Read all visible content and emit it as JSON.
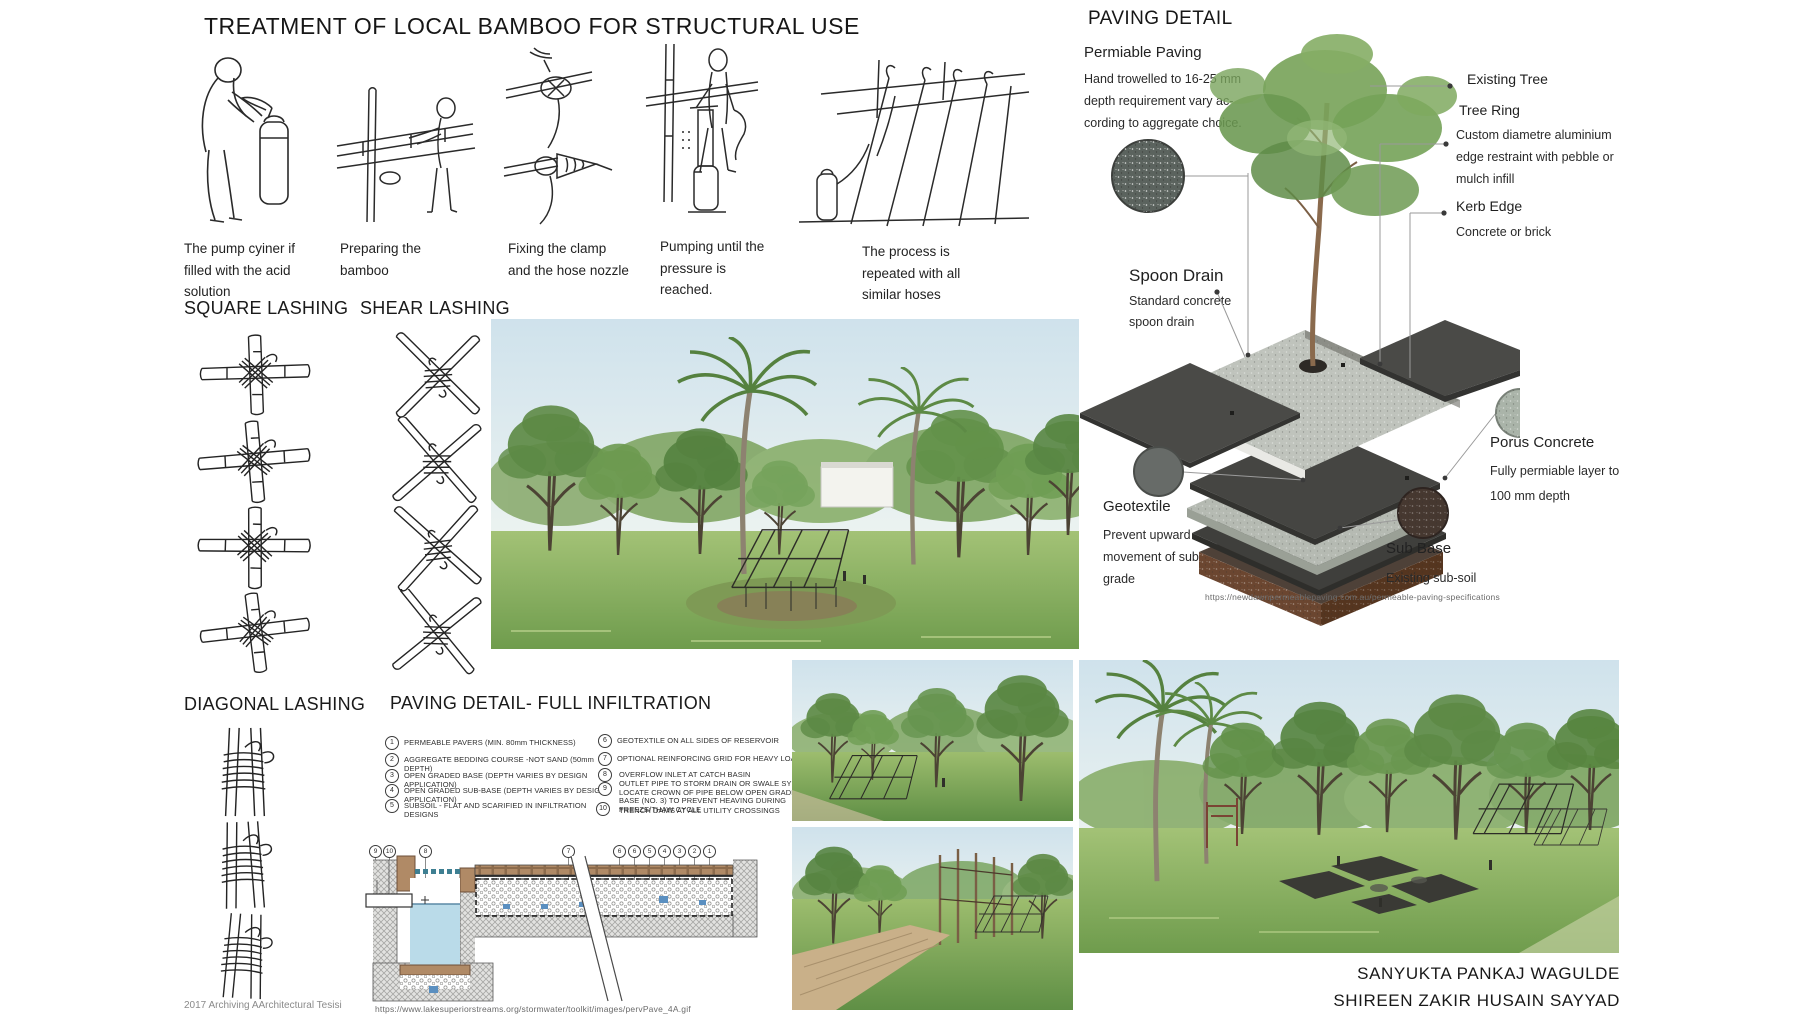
{
  "bamboo_treatment": {
    "title": "TREATMENT OF LOCAL BAMBOO FOR STRUCTURAL USE",
    "steps": [
      {
        "caption": "The pump cyiner if filled with the acid solution"
      },
      {
        "caption": "Preparing the bamboo"
      },
      {
        "caption": "Fixing the clamp and the hose nozzle"
      },
      {
        "caption": "Pumping until the pressure is reached."
      },
      {
        "caption": "The process is repeated with all similar hoses"
      }
    ]
  },
  "lashing": {
    "square_title": "SQUARE LASHING",
    "shear_title": "SHEAR LASHING",
    "diagonal_title": "DIAGONAL LASHING",
    "archive_note": "2017 Archiving AArchitectural Tesisi"
  },
  "infiltration": {
    "title": "PAVING DETAIL- FULL INFILTRATION",
    "legend": [
      {
        "num": "1",
        "text": "PERMEABLE PAVERS (MIN. 80mm THICKNESS)"
      },
      {
        "num": "2",
        "text": "AGGREGATE BEDDING COURSE -NOT SAND (50mm DEPTH)"
      },
      {
        "num": "3",
        "text": "OPEN GRADED BASE (DEPTH VARIES BY DESIGN APPLICATION)"
      },
      {
        "num": "4",
        "text": "OPEN GRADED SUB-BASE (DEPTH VARIES BY DESIGN APPLICATION)"
      },
      {
        "num": "5",
        "text": "SUBSOIL - FLAT AND SCARIFIED IN INFILTRATION DESIGNS"
      },
      {
        "num": "6",
        "text": "GEOTEXTILE ON ALL SIDES OF RESERVOIR"
      },
      {
        "num": "7",
        "text": "OPTIONAL REINFORCING GRID FOR HEAVY LOADS"
      },
      {
        "num": "8",
        "text": "OVERFLOW INLET AT CATCH BASIN"
      },
      {
        "num": "9",
        "text": "OUTLET PIPE TO STORM DRAIN OR SWALE SYSTEM. LOCATE CROWN OF PIPE BELOW OPEN GRADED BASE (NO. 3) TO PREVENT HEAVING DURING FREEZE/THAW CYCLE"
      },
      {
        "num": "10",
        "text": "TRENCH DAMS AT ALL UTILITY CROSSINGS"
      }
    ],
    "markers": [
      "9",
      "10",
      "8",
      "7",
      "6",
      "6",
      "5",
      "4",
      "3",
      "2",
      "1"
    ],
    "source_url": "https://www.lakesuperiorstreams.org/stormwater/toolkit/images/pervPave_4A.gif"
  },
  "paving_detail": {
    "title": "PAVING DETAIL",
    "permeable_paving": {
      "title": "Permiable Paving",
      "lines": [
        "Hand trowelled to 16-25 mm",
        "depth requirement vary ac-",
        "cording to aggregate choice."
      ]
    },
    "existing_tree": {
      "title": "Existing Tree"
    },
    "tree_ring": {
      "title": "Tree Ring",
      "lines": [
        "Custom diametre aluminium",
        "edge restraint with pebble or",
        "mulch infill"
      ]
    },
    "kerb_edge": {
      "title": "Kerb Edge",
      "lines": [
        "Concrete or brick"
      ]
    },
    "spoon_drain": {
      "title": "Spoon Drain",
      "lines": [
        "Standard concrete",
        "spoon drain"
      ]
    },
    "geotextile": {
      "title": "Geotextile",
      "lines": [
        "Prevent upward",
        "movement of sub",
        "grade"
      ]
    },
    "porus_concrete": {
      "title": "Porus Concrete",
      "lines": [
        "Fully permiable layer to",
        "100 mm depth"
      ]
    },
    "sub_base": {
      "title": "Sub Base",
      "lines": [
        "Existing sub-soil"
      ]
    },
    "source_url": "https://newdawnpermeablepaving.com.au/permeable-paving-specifications"
  },
  "credits": {
    "line1": "SANYUKTA PANKAJ WAGULDE",
    "line2": "SHIREEN ZAKIR HUSAIN SAYYAD"
  },
  "colors": {
    "accent_green": "#6d9a50",
    "paving_dark": "#454542",
    "subbase_brown": "#6b4630",
    "water_blue": "#badbe9"
  }
}
